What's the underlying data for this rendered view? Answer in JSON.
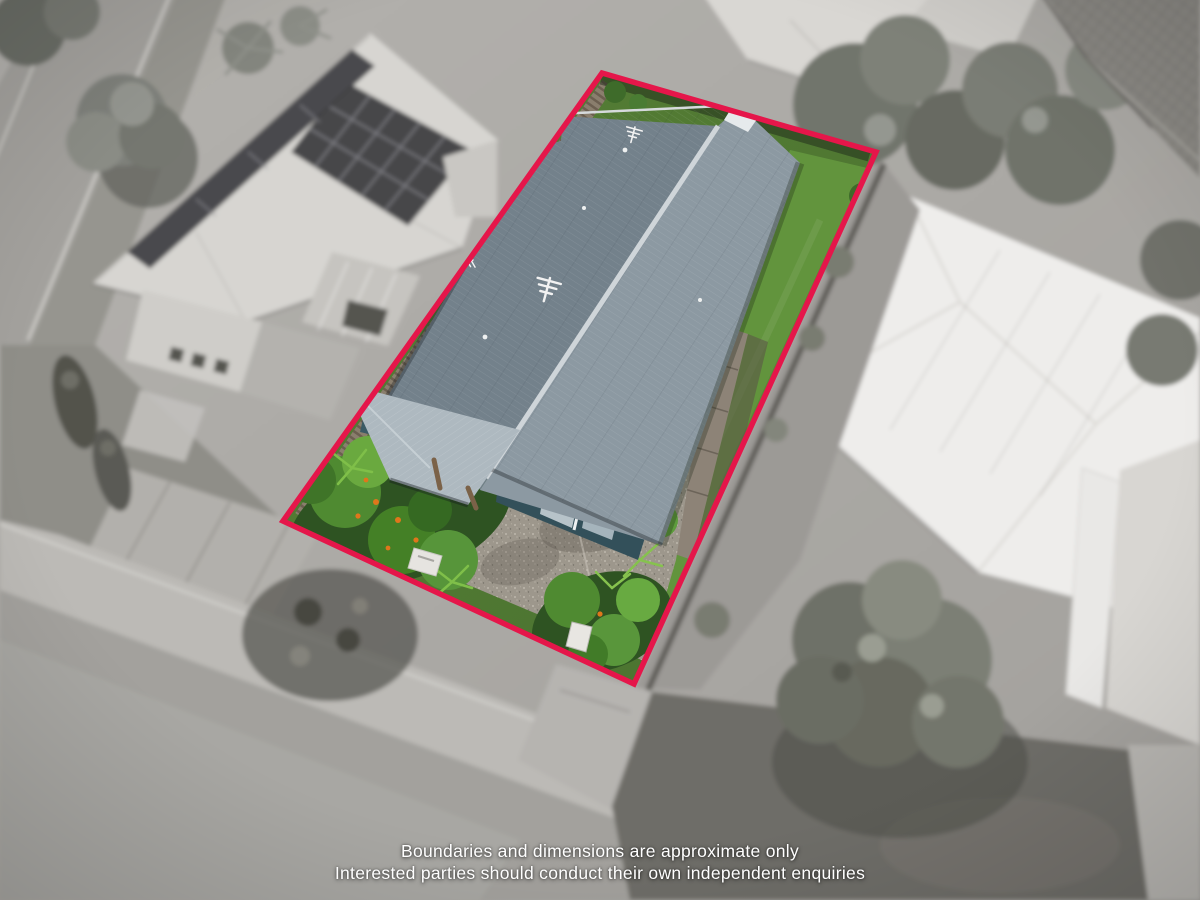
{
  "scene": {
    "type": "aerial-drone-photograph of a residential property",
    "style": "surroundings desaturated and blurred; subject lot shown in colour inside a red boundary overlay"
  },
  "boundary": {
    "color": "#e5164a",
    "stroke_width": "5.5"
  },
  "disclaimer": {
    "line1": "Boundaries and dimensions are approximate only",
    "line2": "Interested parties should conduct their own independent enquiries"
  },
  "colors": {
    "roof_left_plane": "#73818b",
    "roof_right_plane": "#8c99a2",
    "roof_ridge": "#cfd5d9",
    "porch_roof": "#aeb9c0",
    "wall_teal": "#33505a",
    "garage_door": "#b7c3c9",
    "lawn_base": "#507b32",
    "backyard_lawn": "#63963e",
    "garden_dark": "#2e5322",
    "shrub_green": "#4f8a31",
    "palm_green": "#7fbf49",
    "flower_orange": "#e0761b",
    "driveway_aggregate": "#9d978c",
    "fence_timber": "#8a7e6d",
    "ac_unit": "#e6e4e0",
    "neighbor_roof": "#d7d5d1",
    "solar_panel": "#46464a",
    "white_roof": "#eeedeb",
    "tiled_roof": "#8a8883",
    "street": "#a3a19d",
    "footpath": "#bcbab6",
    "front_lawn_gray": "#6e6d67",
    "tree_gray": "#73756d",
    "text": "#ffffff"
  }
}
